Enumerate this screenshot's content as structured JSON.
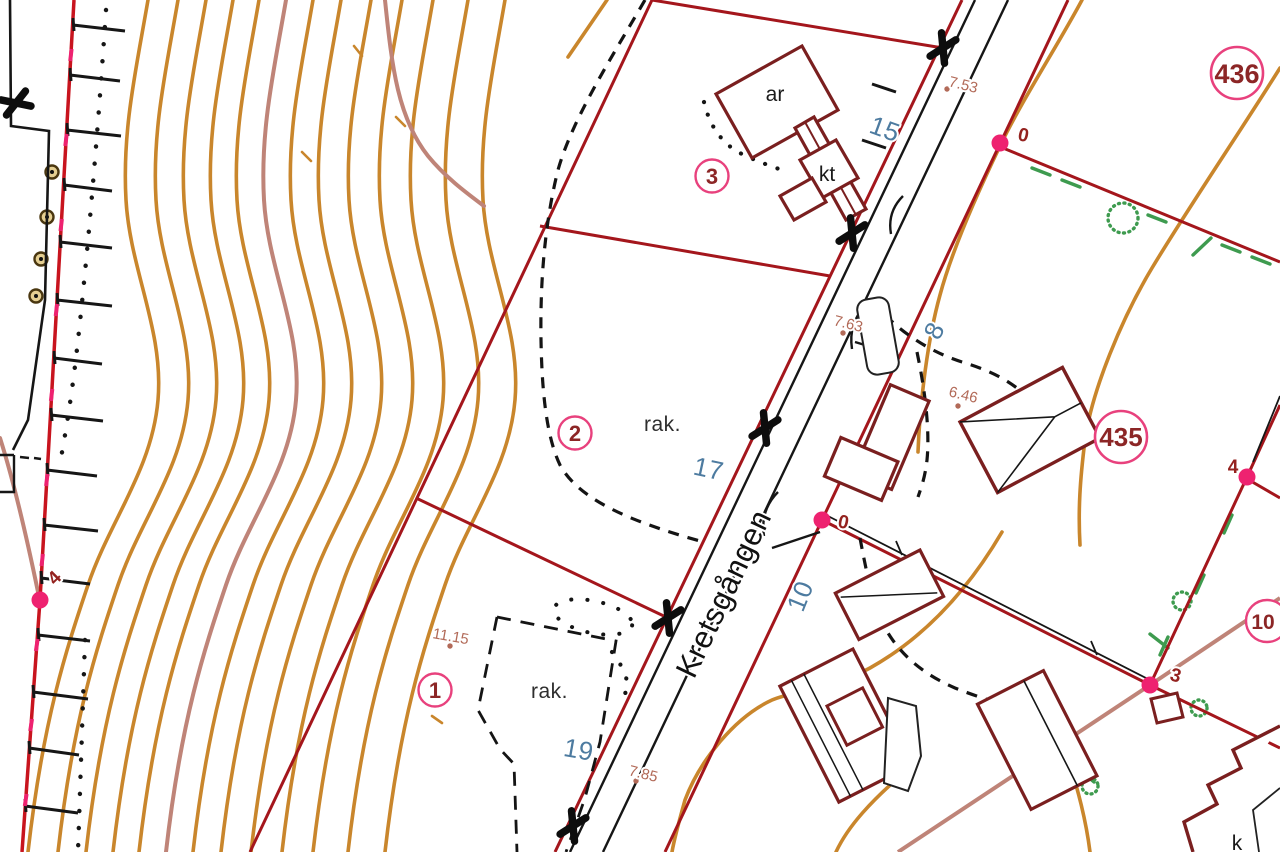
{
  "map": {
    "street": {
      "name": "Kretsgången"
    },
    "block_labels": {
      "block_436": "436",
      "block_435": "435",
      "block_partial": "10"
    },
    "parcel_numbers": {
      "p1": "1",
      "p2": "2",
      "p3": "3"
    },
    "address_numbers": {
      "a15": "15",
      "a17": "17",
      "a19": "19",
      "a8": "8",
      "a10": "10"
    },
    "building_labels": {
      "ar": "ar",
      "kt": "kt",
      "k": "k"
    },
    "ground_labels": {
      "rak_parcel2": "rak.",
      "rak_parcel1": "rak."
    },
    "elevations": {
      "e753": "7.53",
      "e763": "7.63",
      "e646": "6.46",
      "e785": "7.85",
      "e1115": "11.15"
    },
    "point_labels": {
      "pA": "0",
      "pB": "0",
      "pC": "4",
      "pD": "3",
      "pE": "4"
    },
    "colors": {
      "contour_orange": "#c9862c",
      "contour_rosy": "#bf8478",
      "boundary_red": "#a4161c",
      "fence_red": "#c8141e",
      "building_red": "#7a1f1f",
      "survey_magenta": "#ee2270",
      "circle_ring_pink": "#e8417d",
      "circle_text_maroon": "#8c2626",
      "address_blue": "#4d7ba0",
      "elevation_rosy": "#b26a58",
      "vegetation_green": "#3e9b4f",
      "line_black": "#161616"
    }
  }
}
